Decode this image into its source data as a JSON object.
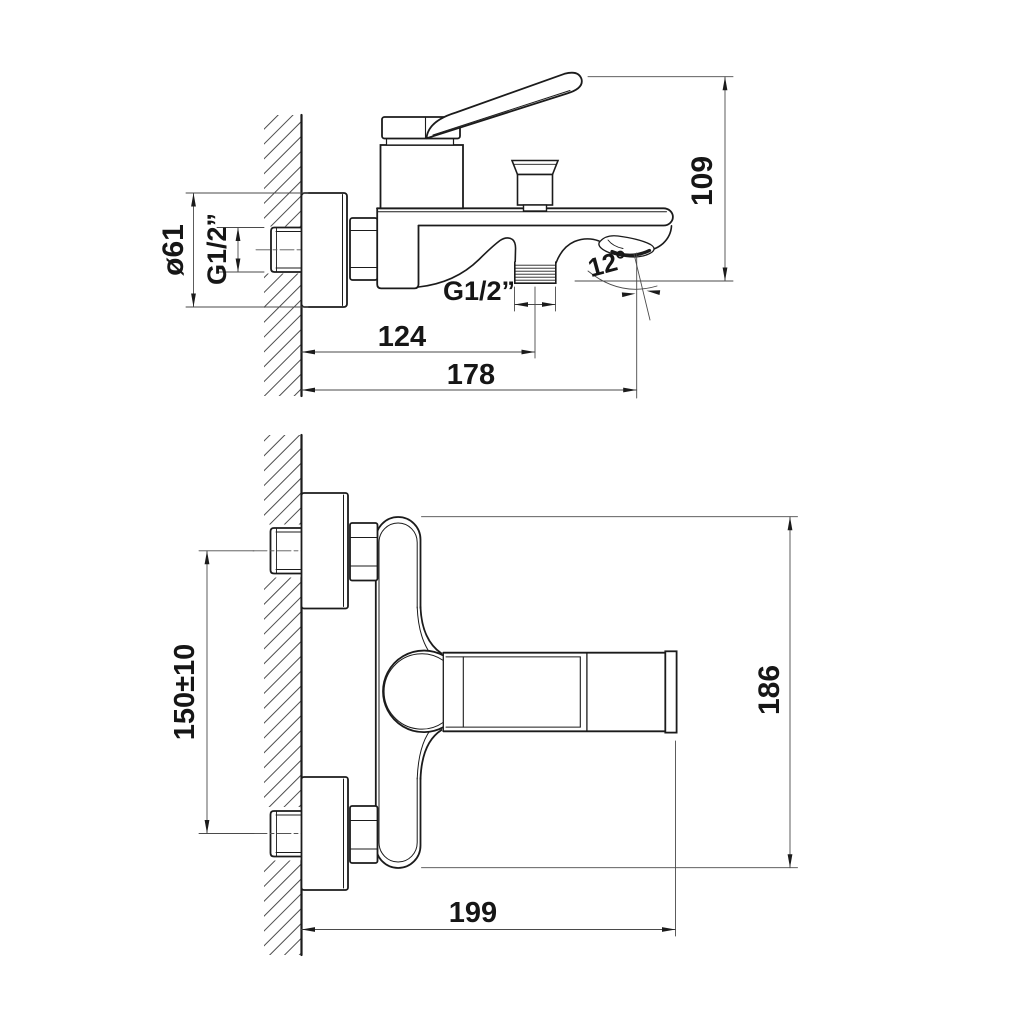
{
  "drawing_title": "wall-mounted bath mixer dimensional drawing",
  "side": {
    "flange_diameter": "ø61",
    "inlet_thread": "G1/2”",
    "height": "109",
    "angle": "12°",
    "outlet_thread": "G1/2”",
    "dim_wall_to_outlet": "124",
    "dim_wall_to_tip": "178"
  },
  "front": {
    "dim_centres": "150±10",
    "dim_height": "186",
    "dim_length": "199"
  },
  "colors": {
    "line": "#1b1b1b",
    "thin": "#4a4a4a",
    "background": "#ffffff"
  }
}
